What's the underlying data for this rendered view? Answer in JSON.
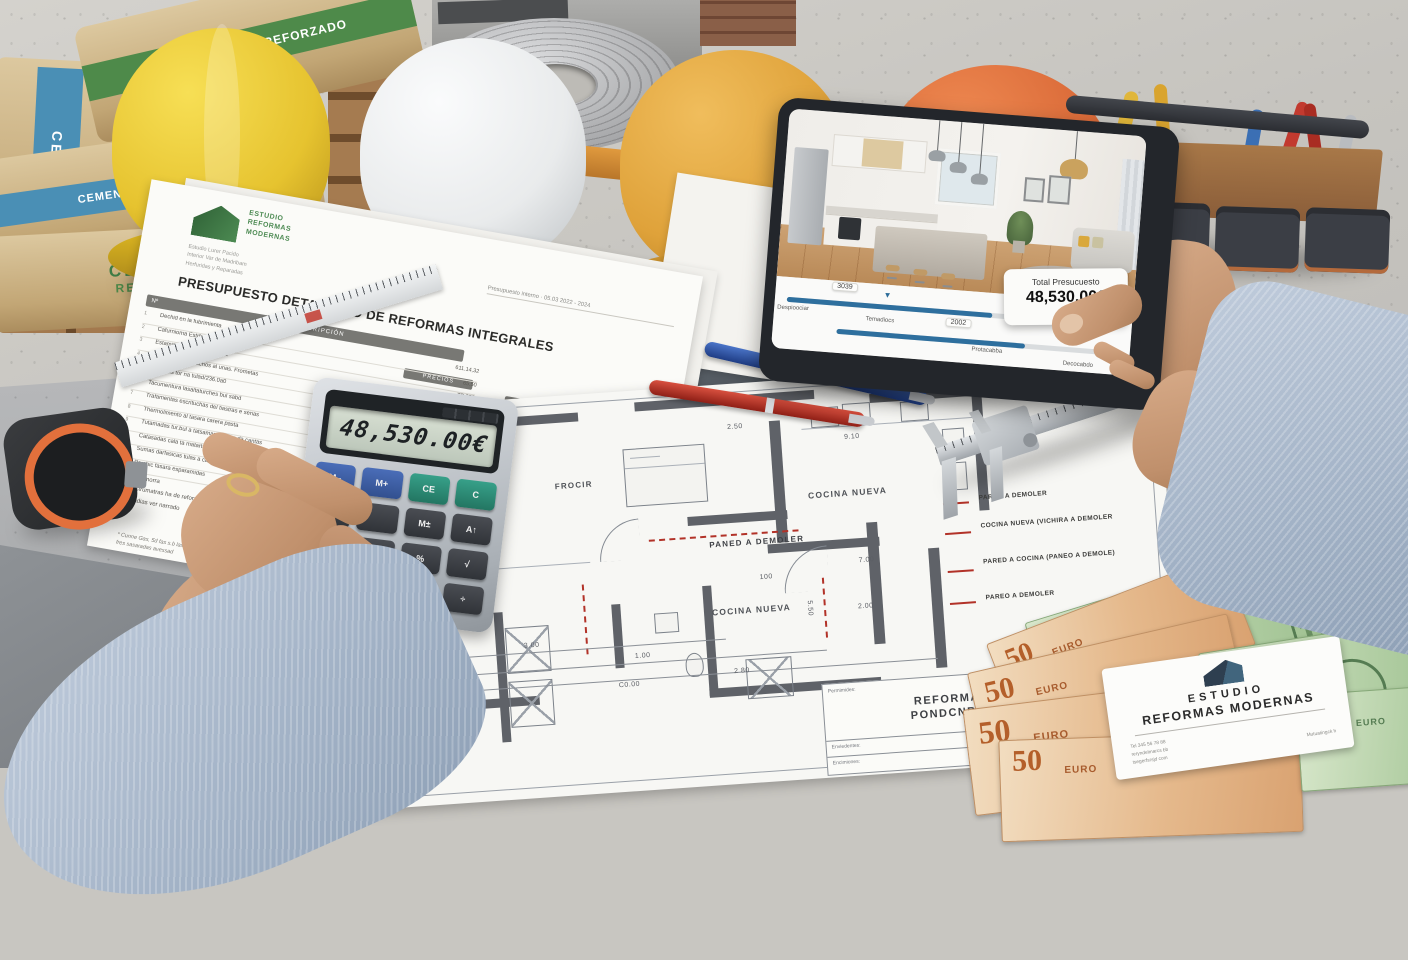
{
  "colors": {
    "brand_green": "#3f7d46",
    "slider_blue": "#2e6f9e",
    "blueprint_red": "#b23228",
    "card_navy": "#2e3f50"
  },
  "cement": {
    "band_green_label": "CEMENTO REFORZADO",
    "band_blue_label": "CEMENTO REFORZADO",
    "side_label_line1": "CEMENTO",
    "side_label_line2": "REFORZADO",
    "vertical_label": "CEMENTO"
  },
  "tablet": {
    "price_title": "Total Presucuesto",
    "price_amount": "48,530.00€",
    "thumb_glyph": "▼",
    "slider1": {
      "chip": "3039",
      "label_left": "Despioociar",
      "label_mid": "Temadiocs",
      "progress": 62
    },
    "slider2": {
      "chip": "2002",
      "label_end": "Protacabba",
      "label_right": "Decocabdo",
      "progress": 66
    }
  },
  "document": {
    "brand_line1": "ESTUDIO",
    "brand_line2": "REFORMAS",
    "brand_line3": "MODERNAS",
    "address_line1": "Estudio Lurer Pacido",
    "address_line2": "Interior Var de Madribam",
    "address_line3": "Herfuridas y Reparadas",
    "meta": "Presupuesto interno · 05.03 2022 - 2024",
    "title": "PRESUPUESTO DETALLADO DE REFORMAS INTEGRALES",
    "col_num": "Nº",
    "col_desc": "DESCRIPCIÓN",
    "col_a": "PRECIOS",
    "col_b": "IMPORTES",
    "rows": [
      {
        "num": "1",
        "desc": "Dechid en la fubrimienta",
        "a": "611.14,32"
      },
      {
        "num": "2",
        "desc": "Cafurnioma Estrfadsorbad turmas",
        "a": "65.50"
      },
      {
        "num": "3",
        "desc": "Estamina 5/a. Desalturbies 1°",
        "a": "TP 252"
      },
      {
        "num": "4",
        "desc": "Chamicas de verachos al unas. Frometas",
        "a": "CU CK57"
      },
      {
        "num": "5",
        "desc": "Estiladas tor na tulad/236.0a0",
        "a": "DB5 7668"
      },
      {
        "num": "6",
        "desc": "Tacumentura lasaltaturches bul sabd",
        "a": "C34.6362"
      },
      {
        "num": "7",
        "desc": "Trafamentas escrituchas del tiastras e serias",
        "a": "E67 8298"
      },
      {
        "num": "8",
        "desc": "Thermolimento al tasara carera pasta",
        "a": "CK7.23"
      },
      {
        "num": "9",
        "desc": "Tutamadas tur.bul a tatsamas tasivas da cantas",
        "a": "JD 258"
      },
      {
        "num": "10",
        "desc": "Catasadas cala ta matartasas",
        "a": "X 5.98"
      },
      {
        "num": "11",
        "desc": "Sumas darfasicas tulas a cantinutas",
        "a": "DR 7.68"
      },
      {
        "num": "12",
        "desc": "Perchic fasara esparamidas",
        "a": "MhJh7"
      }
    ],
    "amounts": [
      "15.796.5058",
      "C55 JC98 5058",
      "E9.93. 0268",
      "CIF. 5.90 5088",
      "6J65.2762,58",
      "JU83 J598",
      "78553,71048"
    ],
    "sub_rows": [
      {
        "num": "1.1",
        "desc": "Chamorra"
      },
      {
        "num": "1.5",
        "desc": "Estrumatras ha de reforzado"
      },
      {
        "num": "1.3",
        "desc": "Padias ver narrado"
      }
    ],
    "total_label": "Fumest ossea",
    "footnote_line1": "* Cunne Gas, 5d fas s.b las dat",
    "footnote_line2": "fres sasaradas avessad"
  },
  "calculator": {
    "display": "48,530.00€",
    "keys": {
      "m_minus": "M–",
      "m_plus": "M+",
      "ce": "CE",
      "c": "C",
      "d5": "5",
      "mi": "M±",
      "at": "A↑",
      "d9": "9",
      "pct": "%",
      "sqrt": "√",
      "plus": "+",
      "minus": "−",
      "mul": "×",
      "div": "÷"
    }
  },
  "blueprint": {
    "room1": "FROCIR",
    "room2": "COCINA NUEVA",
    "room3": "COCINA NUEVA",
    "note_center": "PANED A DEMOLER",
    "legend": [
      "PARED A DEMOLER",
      "COCINA NUEVA (VICHIRA A DEMOLER",
      "PARED A COCINA (PANEO A DEMOLE)",
      "PAREO A DEMOLER"
    ],
    "dim_300": "3.00",
    "dim_100": "1.00",
    "dim_c000": "C0.00",
    "dim_280": "2 80",
    "dim_100b": "100",
    "dim_700": "7.00",
    "dim_200": "2.00",
    "dim_910": "9.10",
    "dim_250": "2.50",
    "dim_550": "5.50",
    "title_block": {
      "label1": "Permimides:",
      "label2": "Enviedentes:",
      "label3": "Encimiones:",
      "label4": "Espacions:",
      "title_line1": "REFORMAN",
      "title_line2": "PONDCNRAL"
    }
  },
  "money": {
    "fifty": "50",
    "hundred": "100",
    "euro_word": "EURO"
  },
  "business_card": {
    "line1": "ESTUDIO",
    "line2": "REFORMAS MODERNAS",
    "contact1": "Tel  345 56 78 88",
    "contact2": "reryndelmarcs bb",
    "contact3": "tsegerfsrsjd com",
    "right_note": "Mutuatingck h"
  }
}
